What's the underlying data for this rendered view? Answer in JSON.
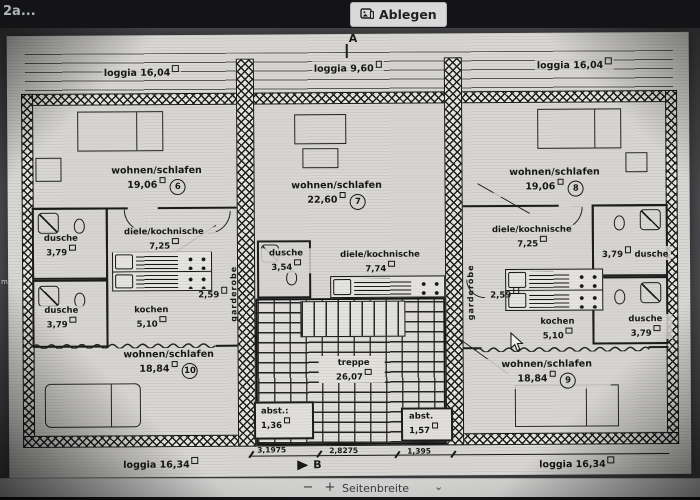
{
  "topbar": {
    "title": "2a...",
    "ablegen": "Ablegen"
  },
  "markers": {
    "top": "A",
    "bottom": "B",
    "edge": "m.m"
  },
  "plan": {
    "loggia_tl": {
      "name": "loggia",
      "area": "16,04"
    },
    "loggia_tc": {
      "name": "loggia",
      "area": "9,60"
    },
    "loggia_tr": {
      "name": "loggia",
      "area": "16,04"
    },
    "wohnen_l": {
      "name": "wohnen/schlafen",
      "area": "19,06",
      "num": "6"
    },
    "wohnen_c": {
      "name": "wohnen/schlafen",
      "area": "22,60",
      "num": "7"
    },
    "wohnen_r": {
      "name": "wohnen/schlafen",
      "area": "19,06",
      "num": "8"
    },
    "dusche_l1": {
      "name": "dusche",
      "area": "3,79"
    },
    "diele_l": {
      "name": "diele/kochnische",
      "area": "7,25"
    },
    "dusche_c": {
      "name": "dusche",
      "area": "3,54"
    },
    "diele_c": {
      "name": "diele/kochnische",
      "area": "7,74"
    },
    "diele_r": {
      "name": "diele/kochnische",
      "area": "7,25"
    },
    "dusche_r1": {
      "name": "dusche",
      "area": "3,79"
    },
    "gard_l": {
      "name": "garderobe",
      "dim": "2,59"
    },
    "gard_r": {
      "name": "garderobe",
      "dim": "2,59"
    },
    "dusche_l2": {
      "name": "dusche",
      "area": "3,79"
    },
    "kochen_l": {
      "name": "kochen",
      "area": "5,10"
    },
    "kochen_r": {
      "name": "kochen",
      "area": "5,10"
    },
    "dusche_r2": {
      "name": "dusche",
      "area": "3,79"
    },
    "wohnen_bl": {
      "name": "wohnen/schlafen",
      "area": "18,84",
      "num": "10"
    },
    "treppe": {
      "name": "treppe",
      "area": "26,07"
    },
    "abst_l": {
      "name": "abst.:",
      "area": "1,36"
    },
    "abst_r": {
      "name": "abst.",
      "area": "1,57"
    },
    "wohnen_br": {
      "name": "wohnen/schlafen",
      "area": "18,84",
      "num": "9"
    },
    "loggia_bl": {
      "name": "loggia",
      "area": "16,34"
    },
    "loggia_br": {
      "name": "loggia",
      "area": "16,34"
    },
    "dims": [
      "3,1975",
      "2,8275",
      "1,395"
    ]
  },
  "toolbar": {
    "zoom_out": "−",
    "zoom_in": "+",
    "fit": "Seitenbreite",
    "chevron": "⌄"
  }
}
